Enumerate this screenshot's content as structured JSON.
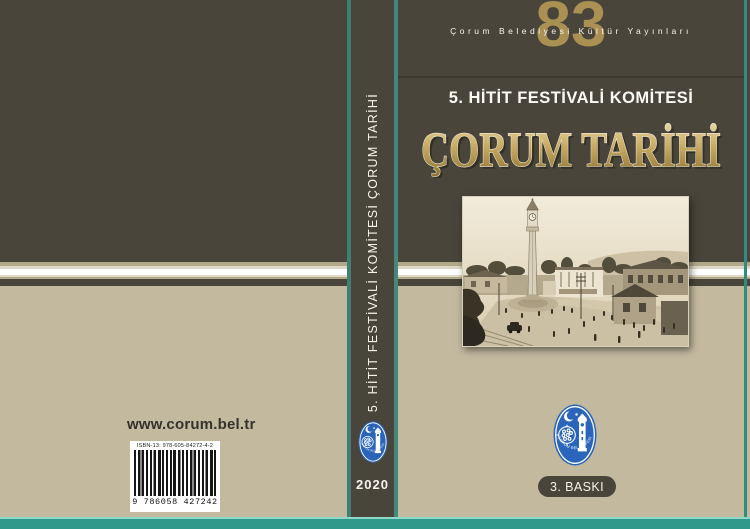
{
  "banner": {
    "publisher_line": "Çorum Belediyesi Kültür Yayınları",
    "series_number": "83"
  },
  "front": {
    "subtitle": "5. HİTİT FESTİVALİ KOMİTESİ",
    "title": "ÇORUM TARİHİ",
    "edition_badge": "3. BASKI",
    "logo_text": "ÇORUM BELEDİYESİ"
  },
  "spine": {
    "label": "5. HİTİT FESTİVALİ KOMİTESİ ÇORUM TARİHİ",
    "year": "2020"
  },
  "back": {
    "website": "www.corum.bel.tr",
    "isbn": "ISBN-13: 978-605-84272-4-2",
    "barcode_digits": "9 786058 427242"
  },
  "colors": {
    "cover_olive": "#49453b",
    "cover_beige": "#c3b99f",
    "teal_accent": "#2f998b",
    "series_gold": "#aa9052",
    "title_gold_light": "#ead9a8",
    "title_gold_dark": "#8d7231",
    "logo_blue": "#2a65bb",
    "ribbon_white": "#ffffff"
  }
}
